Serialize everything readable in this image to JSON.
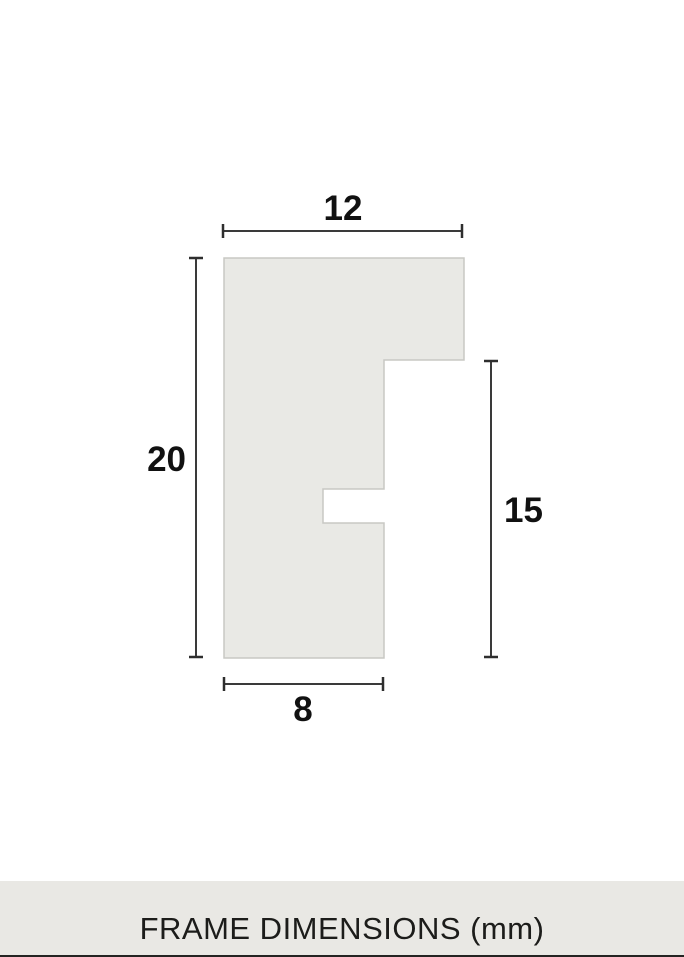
{
  "diagram": {
    "type": "frame-profile-cross-section",
    "dimensions": {
      "top_width": "12",
      "left_height": "20",
      "right_height": "15",
      "bottom_width": "8"
    },
    "unit": "mm"
  },
  "footer": {
    "caption": "FRAME DIMENSIONS (mm)"
  },
  "colors": {
    "background": "#ffffff",
    "shape_fill": "#e9e9e5",
    "shape_border": "#c8c8c4",
    "dimension_line": "#3a3a3a",
    "label_text": "#111111",
    "footer_background": "#e9e8e4",
    "footer_text": "#1c1c1a",
    "bottom_strip": "#232321"
  }
}
